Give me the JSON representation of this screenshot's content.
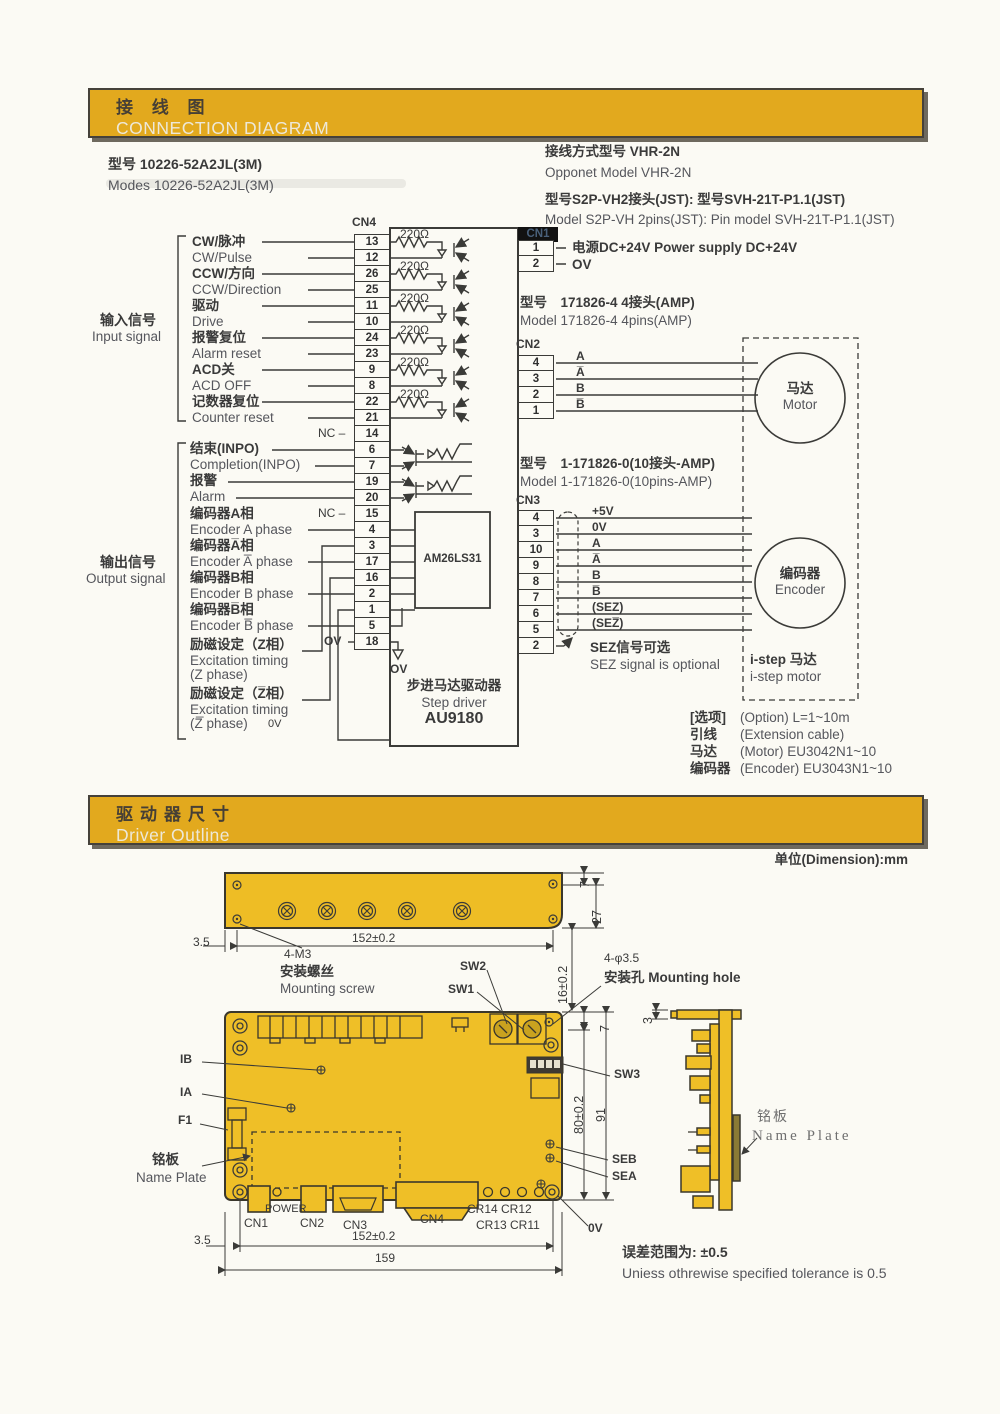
{
  "banner1": {
    "zh": "接 线 图",
    "en": "CONNECTION DIAGRAM"
  },
  "banner2": {
    "zh": "驱动器尺寸",
    "en": "Driver Outline"
  },
  "conn": {
    "model_zh": "型号 10226-52A2JL(3M)",
    "model_en": "Modes 10226-52A2JL(3M)",
    "opp_zh": "接线方式型号 VHR-2N",
    "opp_en": "Opponet Model VHR-2N",
    "jst_zh": "型号S2P-VH2接头(JST): 型号SVH-21T-P1.1(JST)",
    "jst_en": "Model S2P-VH 2pins(JST): Pin model SVH-21T-P1.1(JST)",
    "cn4": "CN4",
    "cn1": "CN1",
    "cn2": "CN2",
    "cn3": "CN3",
    "r220": "220Ω",
    "nc": "NC –",
    "ov": "OV",
    "ov0": "0V",
    "in_zh": "输入信号",
    "in_en": "Input signal",
    "out_zh": "输出信号",
    "out_en": "Output signal",
    "inputs": [
      {
        "zh": "CW/脉冲",
        "en": "CW/Pulse"
      },
      {
        "zh": "CCW/方向",
        "en": "CCW/Direction"
      },
      {
        "zh": "驱动",
        "en": "Drive"
      },
      {
        "zh": "报警复位",
        "en": "Alarm reset"
      },
      {
        "zh": "ACD关",
        "en": "ACD OFF"
      },
      {
        "zh": "记数器复位",
        "en": "Counter reset"
      }
    ],
    "outputs": [
      {
        "zh": "结束(INPO)",
        "en": "Completion(INPO)"
      },
      {
        "zh": "报警",
        "en": "Alarm"
      },
      {
        "zh": "编码器A相",
        "en": "Encoder A phase"
      },
      {
        "zh": "编码器A̅相",
        "en": "Encoder A̅ phase"
      },
      {
        "zh": "编码器B相",
        "en": "Encoder B phase"
      },
      {
        "zh": "编码器B̅相",
        "en": "Encoder B̅ phase"
      },
      {
        "zh": "励磁设定（Z相）",
        "en": "Excitation timing",
        "en2": "(Z phase)"
      },
      {
        "zh": "励磁设定（Z̅相）",
        "en": "Excitation timing",
        "en2": "(Z̅ phase)"
      }
    ],
    "cn4_pins": [
      "13",
      "12",
      "26",
      "25",
      "11",
      "10",
      "24",
      "23",
      "9",
      "8",
      "22",
      "21",
      "14",
      "6",
      "7",
      "19",
      "20",
      "15",
      "4",
      "3",
      "17",
      "16",
      "2",
      "1",
      "5",
      "18"
    ],
    "cn1_pins": [
      "1",
      "2"
    ],
    "cn1_l1": "电源DC+24V Power supply DC+24V",
    "cn1_l2": "OV",
    "amp4_zh": "型号　171826-4  4接头(AMP)",
    "amp4_en": "Model 171826-4  4pins(AMP)",
    "cn2_pins": [
      "4",
      "3",
      "2",
      "1"
    ],
    "cn2_sigs": [
      "A",
      "A̅",
      "B",
      "B̅"
    ],
    "motor_zh": "马达",
    "motor_en": "Motor",
    "amp10_zh": "型号　1-171826-0(10接头-AMP)",
    "amp10_en": "Model 1-171826-0(10pins-AMP)",
    "cn3_pins": [
      "4",
      "3",
      "10",
      "9",
      "8",
      "7",
      "6",
      "5",
      "2"
    ],
    "cn3_sigs": [
      "+5V",
      "0V",
      "A",
      "A̅",
      "B",
      "B̅",
      "(SEZ)",
      "(SEZ̅)"
    ],
    "sez_zh": "SEZ信号可选",
    "sez_en": "SEZ signal is optional",
    "enc_zh": "编码器",
    "enc_en": "Encoder",
    "istep_zh": "i-step 马达",
    "istep_en": "i-step motor",
    "chip": "AM26LS31",
    "drv_zh": "步进马达驱动器",
    "drv_en": "Step driver",
    "drv_model": "AU9180",
    "opts": [
      {
        "zh": "[选项]",
        "en": "(Option)  L=1~10m"
      },
      {
        "zh": "引线",
        "en": "(Extension cable)"
      },
      {
        "zh": "马达",
        "en": "(Motor) EU3042N1~10"
      },
      {
        "zh": "编码器",
        "en": "(Encoder) EU3043N1~10"
      }
    ]
  },
  "out": {
    "unit": "单位(Dimension):mm",
    "d7a": "7",
    "d27": "27",
    "d35a": "3.5",
    "d152a": "152±0.2",
    "d16": "16±0.2",
    "m3": "4-M3",
    "screw_zh": "安装螺丝",
    "screw_en": "Mounting screw",
    "sw1": "SW1",
    "sw2": "SW2",
    "sw3": "SW3",
    "hole": "4-φ3.5",
    "hole_line": "安装孔 Mounting hole",
    "d7b": "7",
    "d80": "80±0.2",
    "d91": "91",
    "d3": "3",
    "ib": "IB",
    "ia": "IA",
    "f1": "F1",
    "np_zh": "铭板",
    "np_en": "Name Plate",
    "power": "POWER",
    "cn1": "CN1",
    "cn2": "CN2",
    "cn3": "CN3",
    "cn4": "CN4",
    "cr1": "CR14 CR12",
    "cr2": "CR13 CR11",
    "ov": "0V",
    "seb": "SEB",
    "sea": "SEA",
    "np2_zh": "铭板",
    "np2_en": "Name Plate",
    "d35b": "3.5",
    "d152b": "152±0.2",
    "d159": "159",
    "tol_zh": "误差范围为:  ±0.5",
    "tol_en": "Uniess othrewise specified tolerance is 0.5"
  }
}
